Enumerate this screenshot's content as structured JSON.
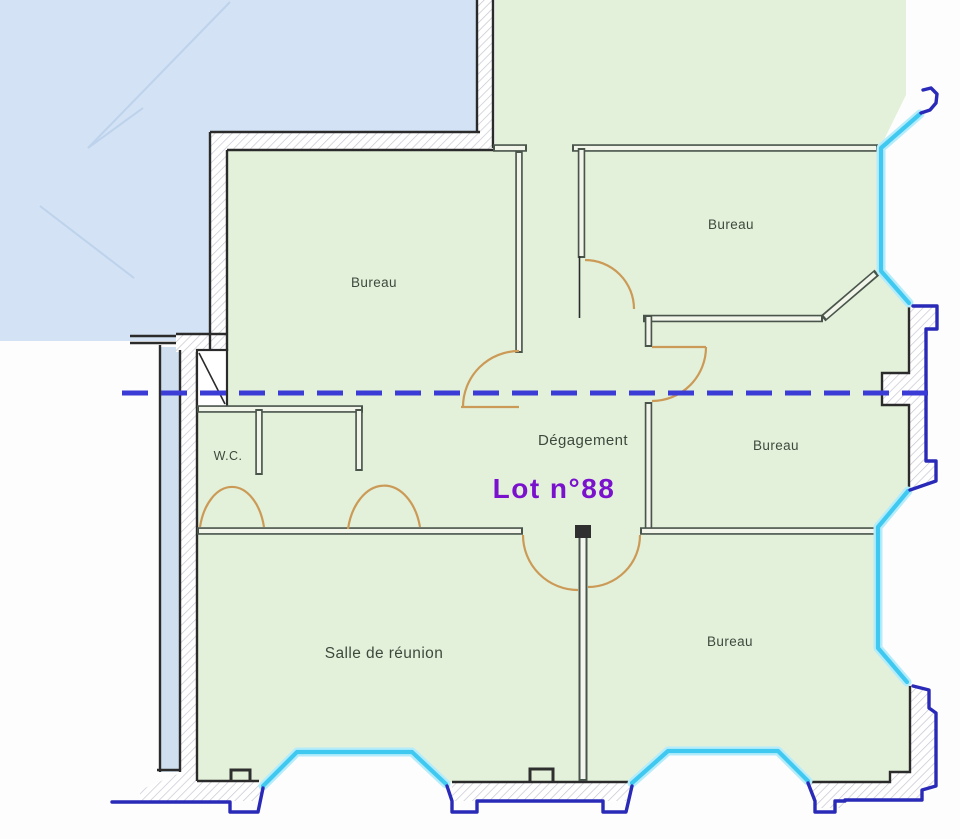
{
  "plan": {
    "lot_label": "Lot n°88",
    "rooms": {
      "bureau_top_left": "Bureau",
      "bureau_top_right": "Bureau",
      "bureau_mid_right": "Bureau",
      "bureau_bottom_right": "Bureau",
      "degagement": "Dégagement",
      "salle_reunion": "Salle de réunion",
      "wc": "W.C."
    },
    "colors": {
      "room_fill": "#e3f1da",
      "adjacent_fill": "#d3e2f4",
      "balcony_fill": "#cfdfef",
      "window_cyan": "#3fc8f0",
      "outer_navy": "#2a2ab8",
      "door_orange": "#cc9a57",
      "cut_line_blue": "#3b3bd6",
      "wall_edge": "#2b2b2b",
      "label_color": "#3d493d",
      "lot_color": "#7a12cd"
    }
  }
}
